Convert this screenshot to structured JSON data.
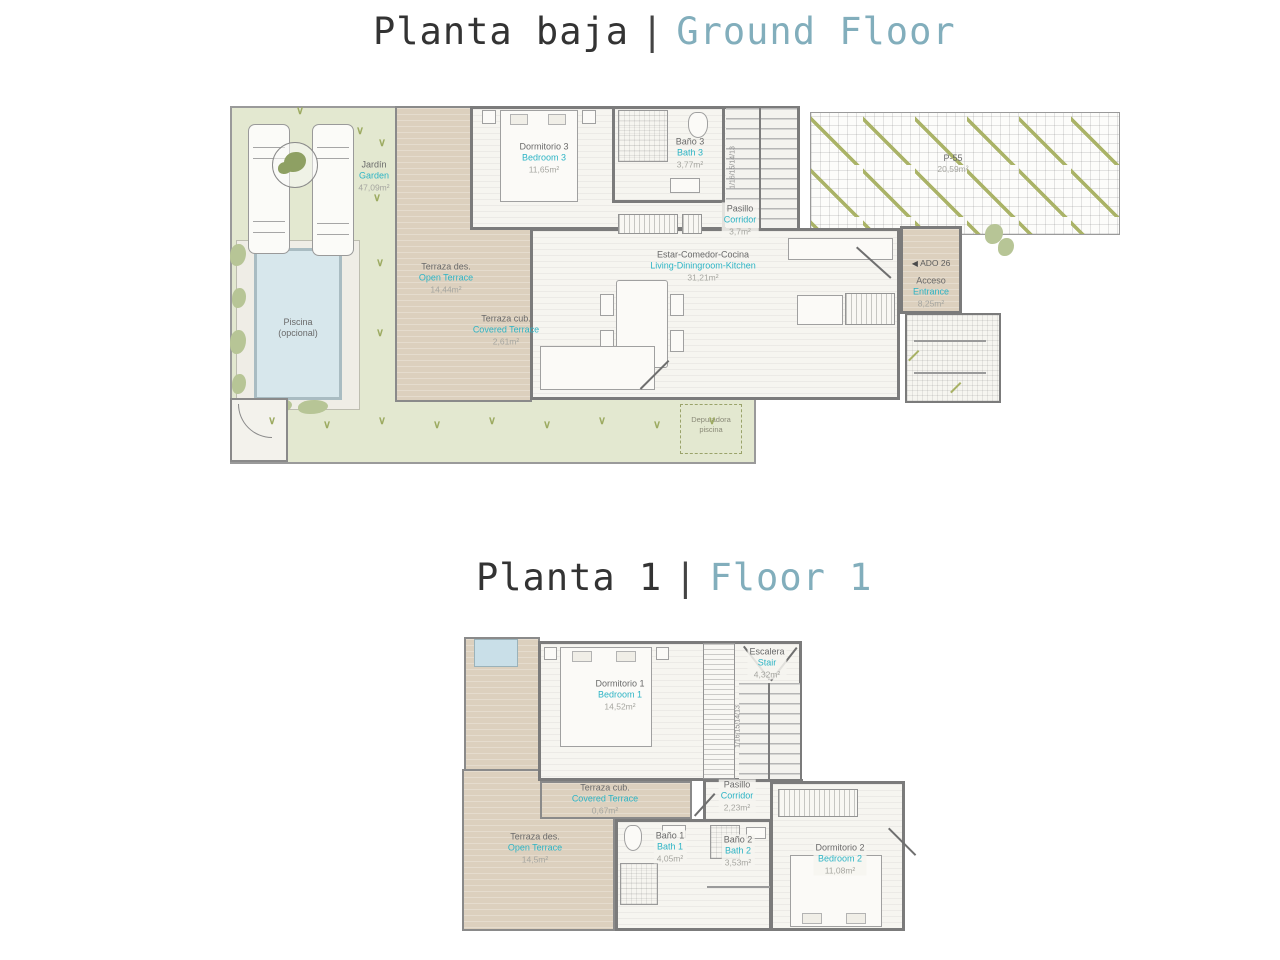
{
  "palette": {
    "title_dark": "#333333",
    "title_teal": "#82aebc",
    "label_dark": "#6a6a6a",
    "label_teal": "#2db4c5",
    "label_gray": "#a6a6a0",
    "garden_green": "#e3e8d0",
    "terrace_tan": "#dcd0be",
    "pool_blue": "#d7e7ec",
    "wall_gray": "#7b7b7b"
  },
  "titles": {
    "ground_es": "Planta baja",
    "ground_sep": "|",
    "ground_en": "Ground Floor",
    "first_es": "Planta 1",
    "first_sep": "|",
    "first_en": "Floor 1"
  },
  "ground": {
    "garden": {
      "es": "Jardín",
      "en": "Garden",
      "area": "47,09m²"
    },
    "pool": {
      "es": "Piscina",
      "es2": "(opcional)"
    },
    "open_terrace": {
      "es": "Terraza des.",
      "en": "Open Terrace",
      "area": "14,44m²"
    },
    "covered_terrace": {
      "es": "Terraza cub.",
      "en": "Covered Terrace",
      "area": "2,61m²"
    },
    "bedroom3": {
      "es": "Dormitorio 3",
      "en": "Bedroom 3",
      "area": "11,65m²"
    },
    "bath3": {
      "es": "Baño 3",
      "en": "Bath 3",
      "area": "3,77m²"
    },
    "corridor": {
      "es": "Pasillo",
      "en": "Corridor",
      "area": "3,7m²"
    },
    "living": {
      "es": "Estar-Comedor-Cocina",
      "en": "Living-Diningroom-Kitchen",
      "area": "31,21m²"
    },
    "entrance": {
      "es": "Acceso",
      "en": "Entrance",
      "area": "8,25m²"
    },
    "ado_label": "ADO 26",
    "parking": {
      "code": "P-55",
      "area": "20,59m²"
    },
    "pump": {
      "line1": "Depuradora",
      "line2": "piscina"
    },
    "stair_numbers": "1/16/15/14/13"
  },
  "first": {
    "bedroom1": {
      "es": "Dormitorio 1",
      "en": "Bedroom 1",
      "area": "14,52m²"
    },
    "stair": {
      "es": "Escalera",
      "en": "Stair",
      "area": "4,32m²"
    },
    "covered_terrace": {
      "es": "Terraza cub.",
      "en": "Covered Terrace",
      "area": "0,67m²"
    },
    "open_terrace": {
      "es": "Terraza des.",
      "en": "Open Terrace",
      "area": "14,5m²"
    },
    "bath1": {
      "es": "Baño 1",
      "en": "Bath 1",
      "area": "4,05m²"
    },
    "bath2": {
      "es": "Baño 2",
      "en": "Bath 2",
      "area": "3,53m²"
    },
    "corridor": {
      "es": "Pasillo",
      "en": "Corridor",
      "area": "2,23m²"
    },
    "bedroom2": {
      "es": "Dormitorio 2",
      "en": "Bedroom 2",
      "area": "11,08m²"
    },
    "stair_numbers": "1/16/15/14/13"
  }
}
